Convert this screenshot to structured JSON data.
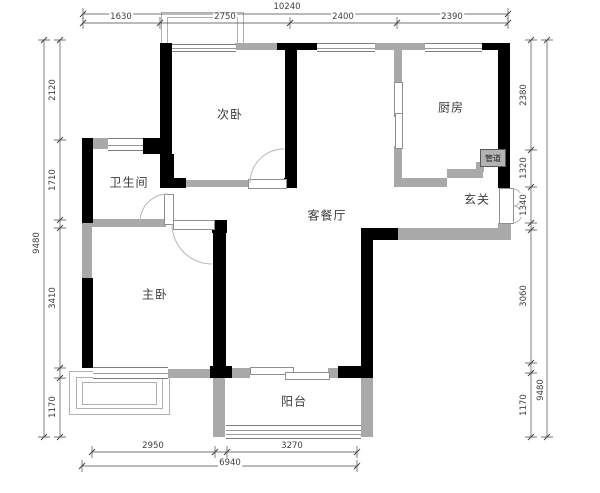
{
  "plan": {
    "title": "apartment-floor-plan",
    "rooms": [
      {
        "name": "secondary-bedroom",
        "label": "次卧"
      },
      {
        "name": "kitchen",
        "label": "厨房"
      },
      {
        "name": "bathroom",
        "label": "卫生间"
      },
      {
        "name": "entryway",
        "label": "玄关"
      },
      {
        "name": "living-dining-room",
        "label": "客餐厅"
      },
      {
        "name": "master-bedroom",
        "label": "主卧"
      },
      {
        "name": "balcony",
        "label": "阳台"
      },
      {
        "name": "pipe-duct",
        "label": "管道"
      }
    ],
    "dimensions": {
      "top_total": "10240",
      "top_segments": [
        "1630",
        "2750",
        "2400",
        "2390"
      ],
      "left_total": "9480",
      "left_segments": [
        "2120",
        "1710",
        "3410",
        "1170"
      ],
      "right_total": "9480",
      "right_segments": [
        "2380",
        "1320",
        "1340",
        "3060",
        "1170"
      ],
      "bottom_total": "6940",
      "bottom_segments": [
        "2950",
        "3270"
      ]
    },
    "colors": {
      "load_bearing_wall": "#000000",
      "partition_wall": "#a9a9a9",
      "background": "#ffffff"
    }
  }
}
